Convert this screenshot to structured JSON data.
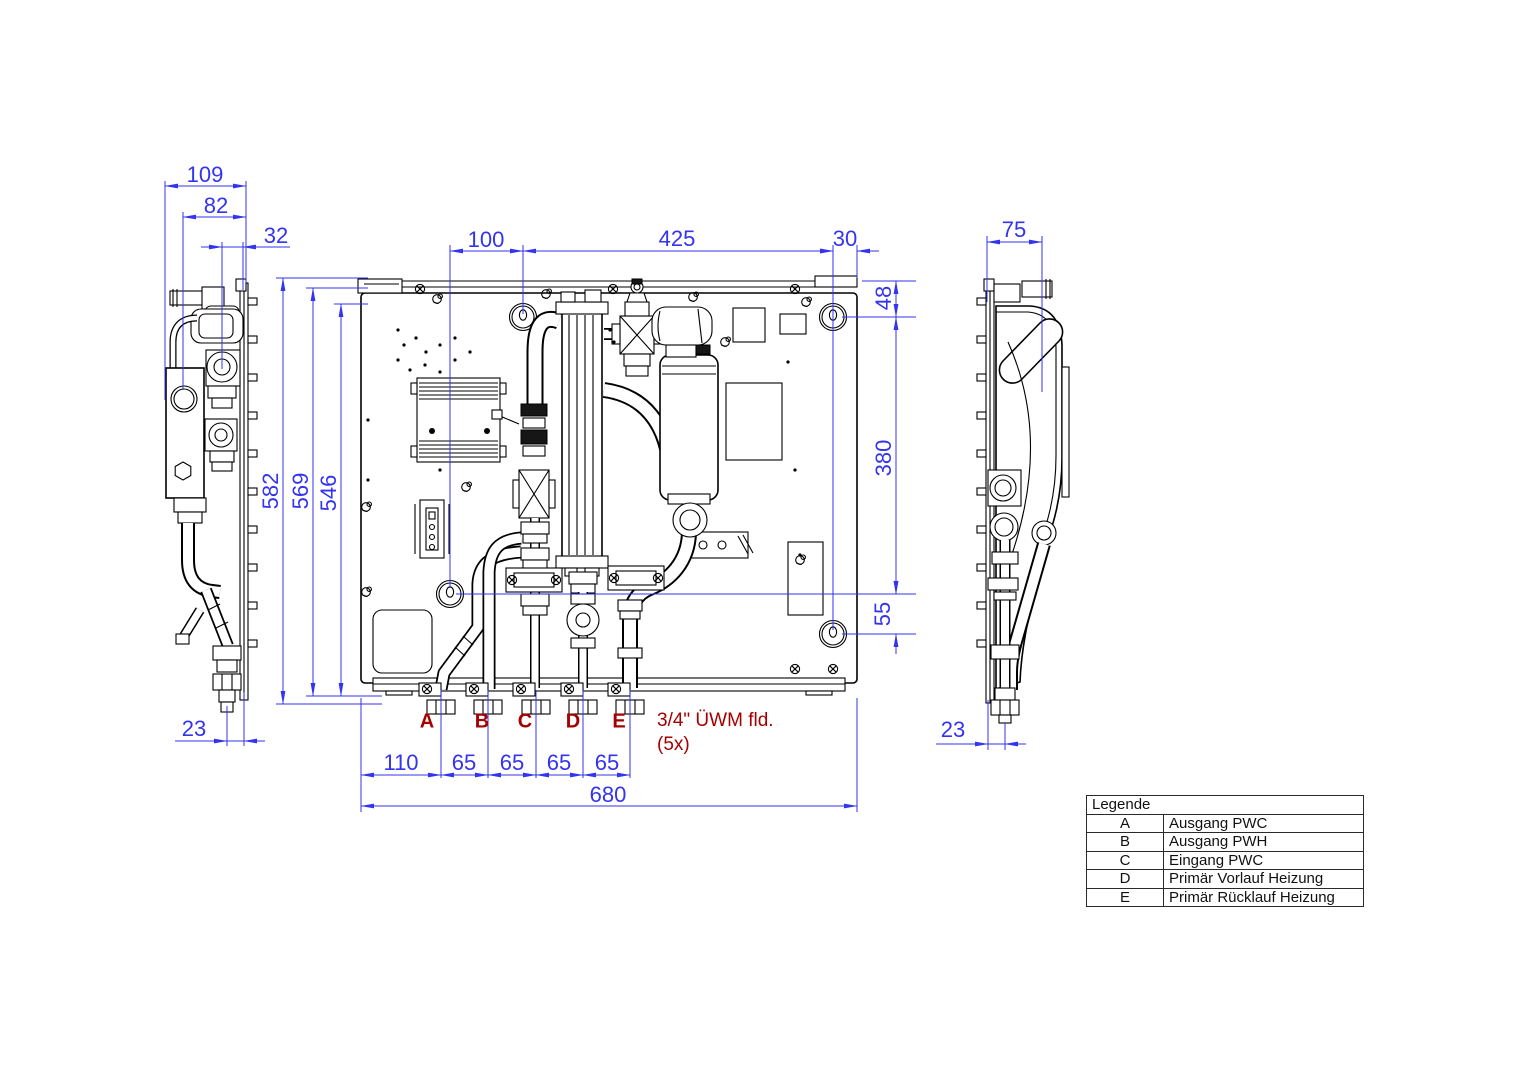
{
  "colors": {
    "dim": "#3333f0",
    "label": "#a40000",
    "line": "#000000",
    "bg": "#ffffff"
  },
  "dims": {
    "d109": "109",
    "d82": "82",
    "d32": "32",
    "d23_left": "23",
    "d100": "100",
    "d425": "425",
    "d30": "30",
    "d582": "582",
    "d569": "569",
    "d546": "546",
    "d48": "48",
    "d380": "380",
    "d55": "55",
    "d110": "110",
    "d65_1": "65",
    "d65_2": "65",
    "d65_3": "65",
    "d65_4": "65",
    "d680": "680",
    "d75": "75",
    "d23_right": "23"
  },
  "connections": {
    "labels": [
      "A",
      "B",
      "C",
      "D",
      "E"
    ],
    "note_line1": "3/4\" ÜWM fld.",
    "note_line2": "(5x)"
  },
  "legend": {
    "title": "Legende",
    "rows": [
      {
        "key": "A",
        "desc": "Ausgang PWC"
      },
      {
        "key": "B",
        "desc": "Ausgang PWH"
      },
      {
        "key": "C",
        "desc": "Eingang PWC"
      },
      {
        "key": "D",
        "desc": "Primär Vorlauf Heizung"
      },
      {
        "key": "E",
        "desc": "Primär Rücklauf Heizung"
      }
    ]
  }
}
